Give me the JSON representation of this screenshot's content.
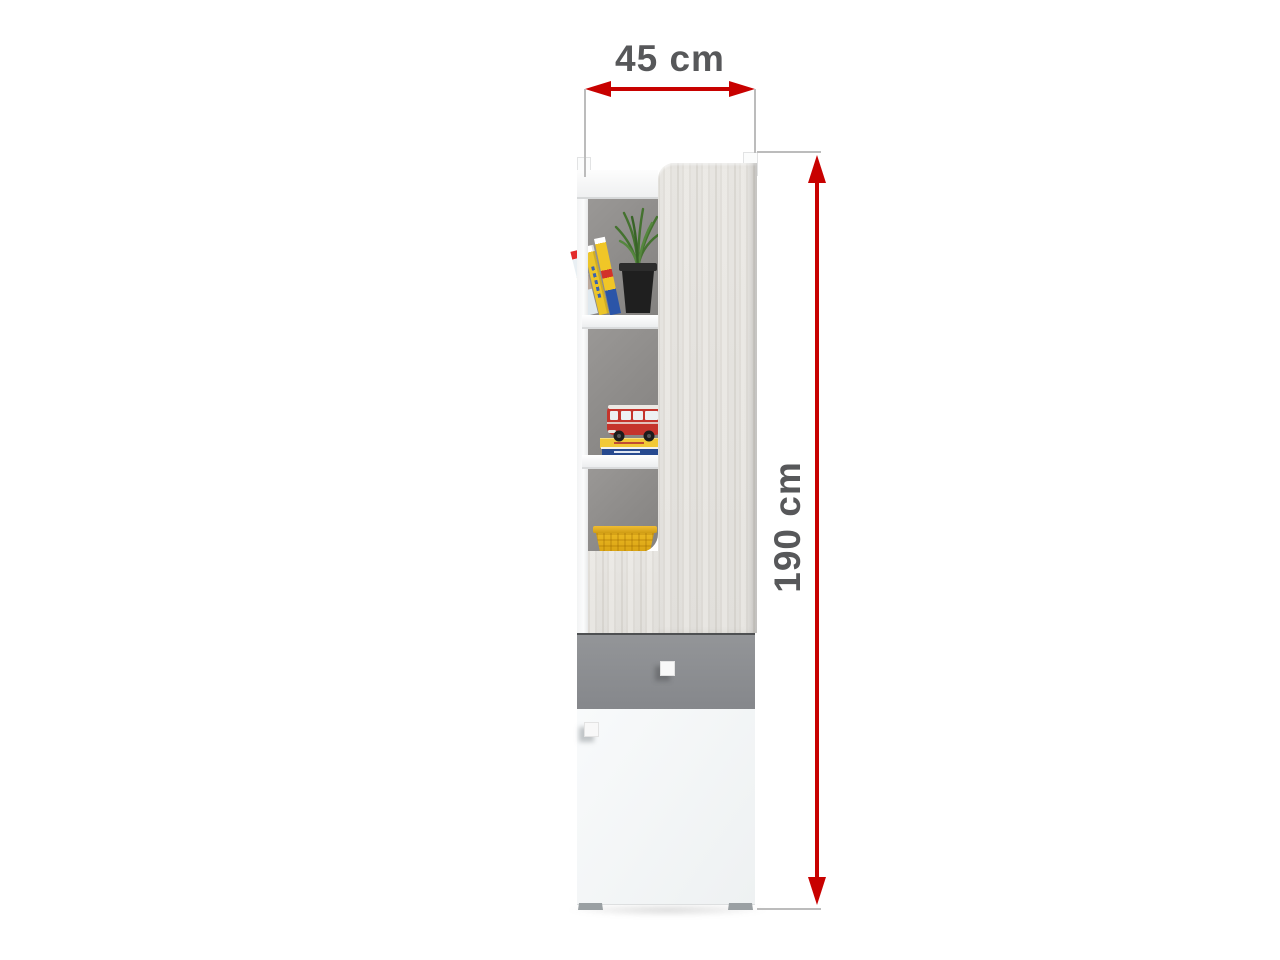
{
  "page": {
    "description": "Product dimension diagram of a tall bookcase cabinet with open shelves, one drawer and one door"
  },
  "dimensions": {
    "width": {
      "label": "45 cm"
    },
    "height": {
      "label": "190 cm"
    }
  },
  "colors": {
    "dimension_arrow_red": "#c80100",
    "dimension_text_gray": "#57585a",
    "extension_line_gray": "#bcbcbc",
    "wood_panel": "#e5e3df",
    "drawer_front_gray": "#8b8d91",
    "door_front_white": "#f4f6f7",
    "carcass_interior_gray": "#8e8c8a",
    "feet_gray": "#9aa0a3",
    "background": "#ffffff"
  },
  "decor": {
    "top_shelf": [
      "leaning-books",
      "potted-grass-plant"
    ],
    "middle_shelf": [
      "red-toy-bus",
      "book-stack"
    ],
    "bottom_shelf": [
      "yellow-wicker-basket"
    ]
  }
}
